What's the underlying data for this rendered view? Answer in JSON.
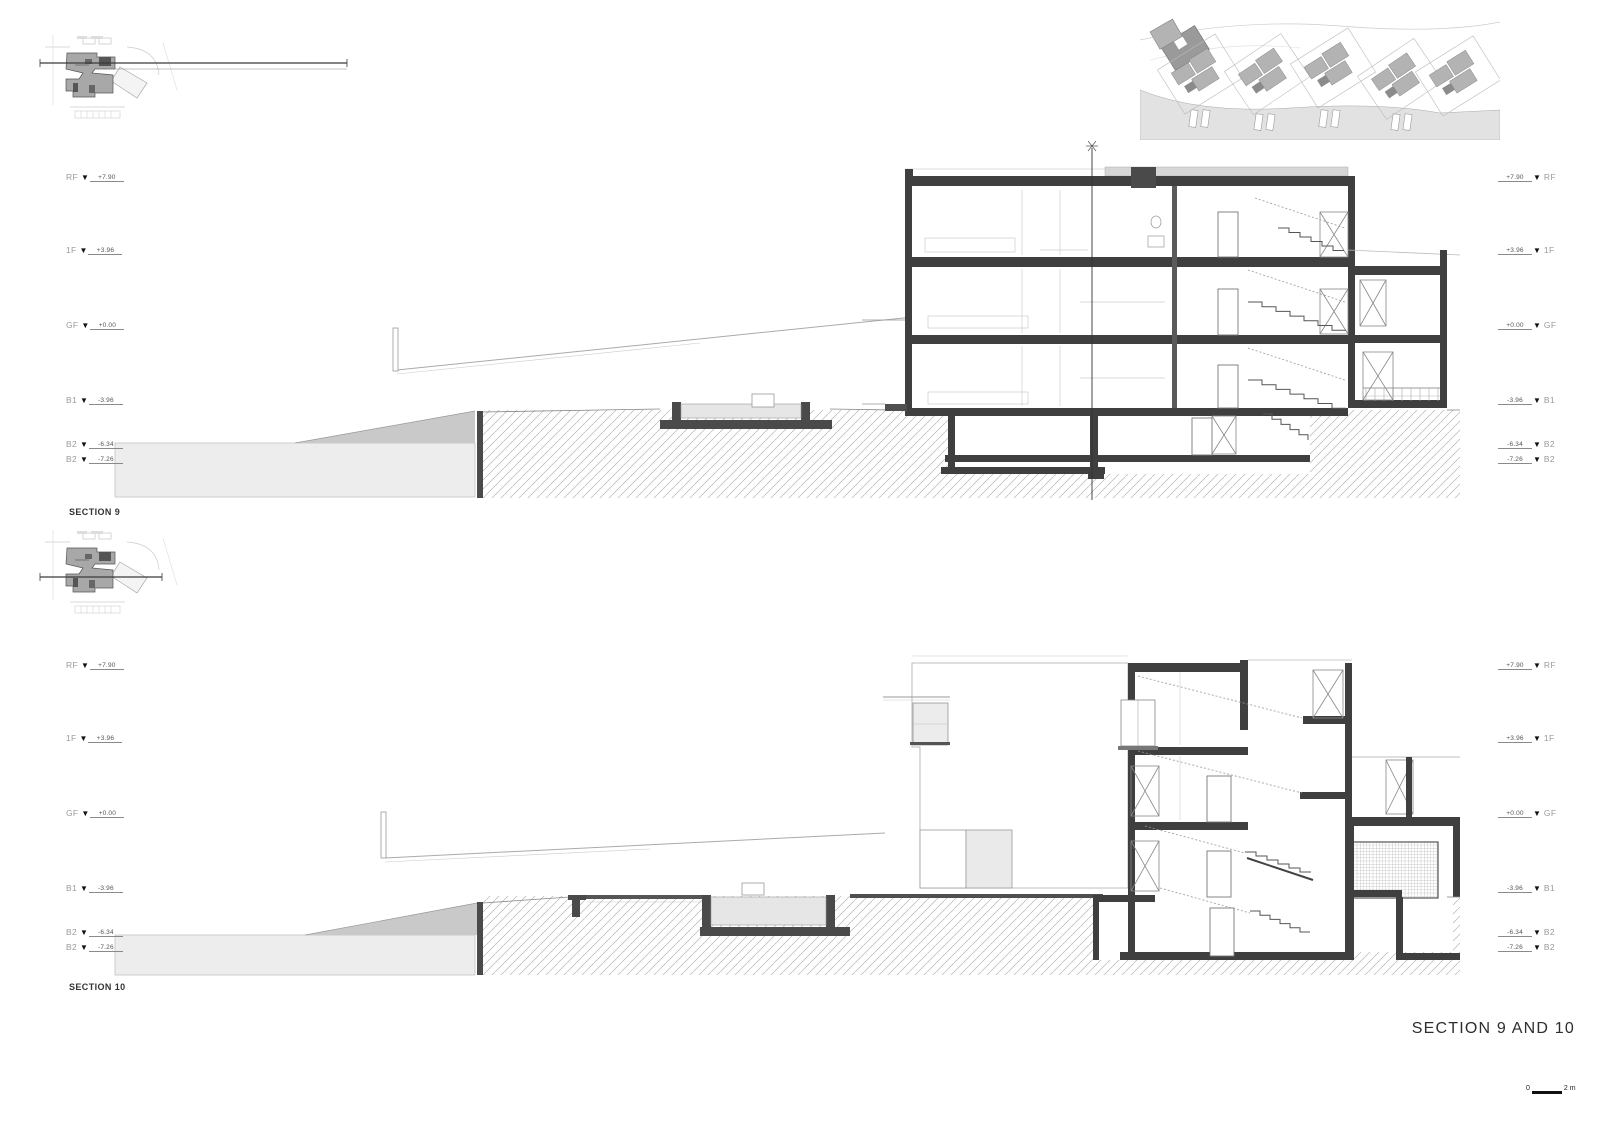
{
  "sheet": {
    "title": "SECTION 9 AND 10",
    "scale_bar": {
      "start": "0",
      "end": "2 m"
    }
  },
  "sections": [
    {
      "label": "SECTION 9",
      "levels": [
        {
          "name": "RF",
          "value": "+7.90"
        },
        {
          "name": "1F",
          "value": "+3.96"
        },
        {
          "name": "GF",
          "value": "+0.00"
        },
        {
          "name": "B1",
          "value": "-3.96"
        },
        {
          "name": "B2",
          "value": "-6.34"
        },
        {
          "name": "B2",
          "value": "-7.26"
        }
      ]
    },
    {
      "label": "SECTION 10",
      "levels": [
        {
          "name": "RF",
          "value": "+7.90"
        },
        {
          "name": "1F",
          "value": "+3.96"
        },
        {
          "name": "GF",
          "value": "+0.00"
        },
        {
          "name": "B1",
          "value": "-3.96"
        },
        {
          "name": "B2",
          "value": "-6.34"
        },
        {
          "name": "B2",
          "value": "-7.26"
        }
      ]
    }
  ],
  "colors": {
    "cut_structure": "#3f3f3f",
    "ground_mass": "#ededed",
    "ramp_wedge": "#c9c9c9",
    "hatch_line": "#b5b5b5",
    "water_gray": "#e2e2e2"
  }
}
